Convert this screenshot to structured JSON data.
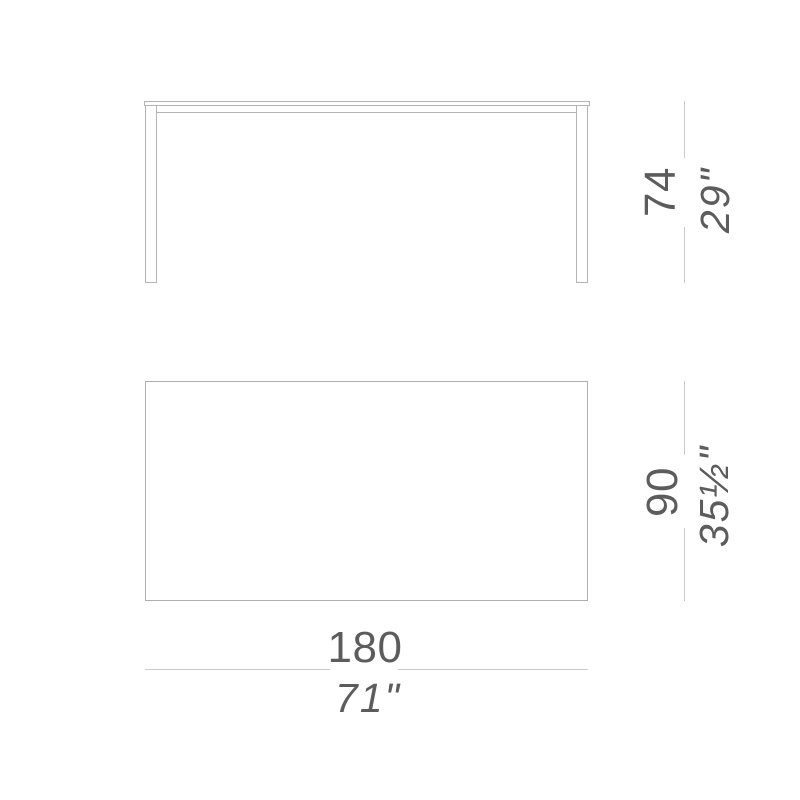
{
  "colors": {
    "bg": "#ffffff",
    "drawing-line": "#b4b4b4",
    "dim-line": "#c9cbcb",
    "text": "#5c5c5c"
  },
  "drawing": {
    "subject": "table technical drawing with front elevation and top plan views"
  },
  "dimensions": {
    "height": {
      "metric": "74",
      "imperial": "29\""
    },
    "depth": {
      "metric": "90",
      "imperial": "35½\""
    },
    "length": {
      "metric": "180",
      "imperial": "71\""
    }
  }
}
